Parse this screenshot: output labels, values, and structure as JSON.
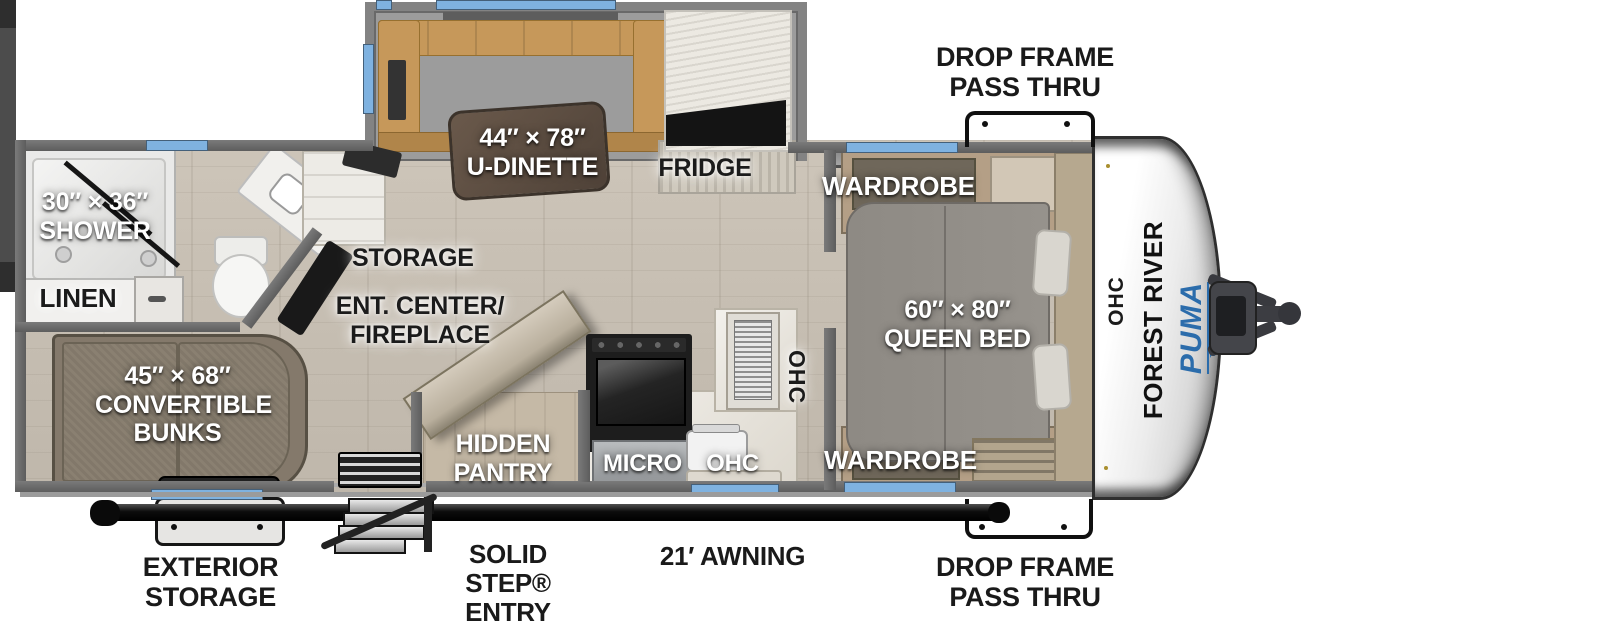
{
  "colors": {
    "window_blue": "#7fb2e0",
    "puma_blue": "#2b6cab",
    "wall_gray": "#6b6b6b"
  },
  "brand": {
    "manufacturer": "FOREST RIVER",
    "model": "PUMA",
    "model_sub": "TRAILERS",
    "front_ohc": "OHC"
  },
  "exterior": {
    "drop_frame_top": {
      "line1": "DROP FRAME",
      "line2": "PASS THRU"
    },
    "drop_frame_bottom": {
      "line1": "DROP FRAME",
      "line2": "PASS THRU"
    },
    "exterior_storage": {
      "line1": "EXTERIOR",
      "line2": "STORAGE"
    },
    "solid_step": {
      "line1": "SOLID STEP®",
      "line2": "ENTRY"
    },
    "awning": "21′ AWNING"
  },
  "interior": {
    "shower": {
      "dim": "30″ × 36″",
      "name": "SHOWER"
    },
    "linen": "LINEN",
    "storage": "STORAGE",
    "ent_center": {
      "line1": "ENT. CENTER/",
      "line2": "FIREPLACE"
    },
    "dinette": {
      "dim": "44″ × 78″",
      "name": "U-DINETTE"
    },
    "fridge": "FRIDGE",
    "wardrobe_top": "WARDROBE",
    "wardrobe_bottom": "WARDROBE",
    "queen_bed": {
      "dim": "60″ × 80″",
      "name": "QUEEN BED"
    },
    "bunks": {
      "dim": "45″ × 68″",
      "line1": "CONVERTIBLE",
      "line2": "BUNKS"
    },
    "hidden_pantry": {
      "line1": "HIDDEN",
      "line2": "PANTRY"
    },
    "micro": "MICRO",
    "ohc_counter": "OHC",
    "ohc_tall": "OHC"
  }
}
